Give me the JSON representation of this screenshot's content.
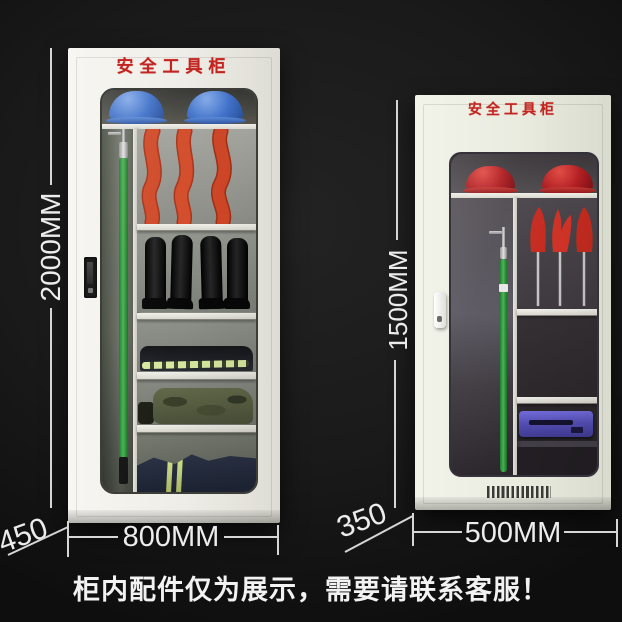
{
  "image": {
    "width": 622,
    "height": 622,
    "background_color": "#151515",
    "type": "product-photo"
  },
  "caption": {
    "text": "柜内配件仅为展示，需要请联系客服！",
    "color": "#f2f2f2"
  },
  "dimension_style": {
    "line_color": "#d6d6d6",
    "text_color": "#ececec"
  },
  "cabinets": {
    "large": {
      "title": "安全工具柜",
      "title_color": "#c32420",
      "body_color": "#eeede7",
      "height_label": "2000MM",
      "width_label": "800MM",
      "depth_label": "450",
      "contents": [
        "blue-safety-helmets",
        "insulated-operating-rod",
        "insulated-gloves",
        "safety-boots",
        "folded-work-clothes-with-reflective-stripe",
        "camouflage-tool-bag",
        "navy-uniform-with-reflective-stripes"
      ]
    },
    "small": {
      "title": "安全工具柜",
      "title_color": "#c32420",
      "body_color": "#e9ebdf",
      "height_label": "1500MM",
      "width_label": "500MM",
      "depth_label": "350",
      "contents": [
        "red-safety-helmets",
        "insulated-operating-rod",
        "insulated-gloves-on-stands",
        "purple-toolbox"
      ]
    }
  },
  "palette": {
    "helmet_blue": "#3f70c8",
    "helmet_red": "#b01e22",
    "glove_orange": "#d04a28",
    "glove_red": "#c62b20",
    "rod_green": "#46b552",
    "toolbox_purple": "#5650b8",
    "reflective_lime": "#d7e9a0",
    "interior_gray_large": "#8d8d87",
    "interior_gray_small": "#45414a"
  }
}
